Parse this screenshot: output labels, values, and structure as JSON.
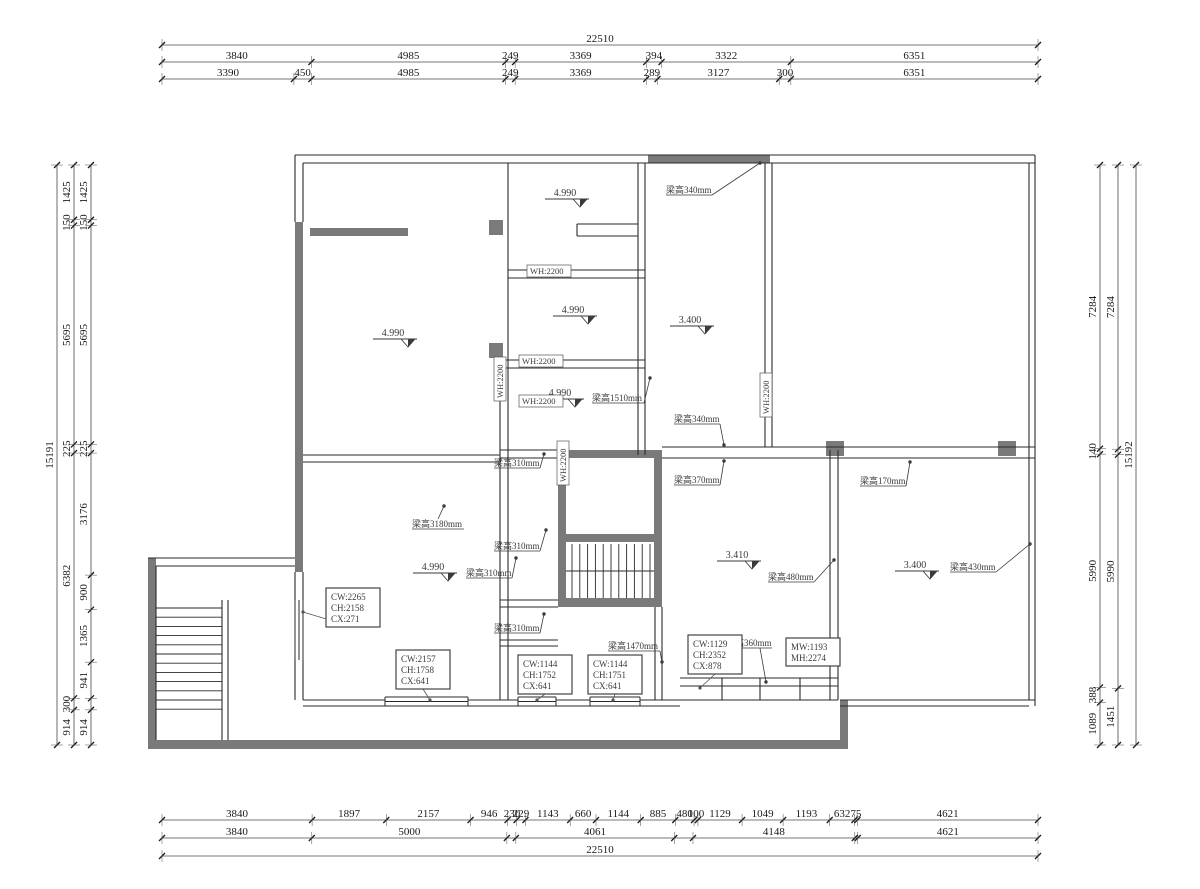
{
  "page": {
    "background": "#ffffff"
  },
  "colors": {
    "wall_fill": "#7a7a7a",
    "line": "#2a2a2a",
    "dim_line": "#4a4a4a",
    "dim_text": "#1a1a1a",
    "annotation_text": "#3a3a3a",
    "background": "#ffffff"
  },
  "dimensions": {
    "top": {
      "overall": "22510",
      "row2": [
        "3840",
        "4985",
        "249",
        "3369",
        "394",
        "3322",
        "6351"
      ],
      "row3": [
        "3390",
        "450",
        "4985",
        "249",
        "3369",
        "289",
        "3127",
        "300",
        "6351"
      ]
    },
    "bottom": {
      "row1": [
        "3840",
        "1897",
        "2157",
        "946",
        "230",
        "229",
        "1143",
        "660",
        "1144",
        "885",
        "480",
        "100",
        "1129",
        "1049",
        "1193",
        "632",
        "75",
        "4621"
      ],
      "row2": [
        "3840",
        "5000",
        "4061",
        "4148",
        "4621"
      ],
      "overall": "22510"
    },
    "left": {
      "overall": "15191",
      "chain_mid": [
        "1425",
        "150",
        "5695",
        "225",
        "6382",
        "300",
        "914"
      ],
      "chain_inner": [
        "1425",
        "150",
        "5695",
        "225",
        "3176",
        "900",
        "1365",
        "941",
        "914"
      ]
    },
    "right": {
      "overall": "15192",
      "chain_inner": [
        "7284",
        "140",
        "5990",
        "388",
        "1089"
      ],
      "chain_mid": [
        "7284",
        "5990",
        "1451"
      ]
    }
  },
  "level_markers": [
    "4.990",
    "4.990",
    "4.990",
    "4.990",
    "3.400",
    "3.410",
    "3.400",
    "4.990"
  ],
  "beam_labels": [
    "梁高340mm",
    "梁高1510mm",
    "梁高340mm",
    "梁高370mm",
    "梁高170mm",
    "梁高480mm",
    "梁高430mm",
    "梁高3180mm",
    "梁高310mm",
    "梁高310mm",
    "梁高310mm",
    "梁高310mm",
    "梁高1470mm",
    "梁高360mm"
  ],
  "window_height_labels": [
    "WH:2200",
    "WH:2200",
    "WH:2200",
    "WH:2200",
    "WH:2200",
    "WH:2200"
  ],
  "opening_size_boxes": [
    {
      "lines": [
        "CW:2265",
        "CH:2158",
        "CX:271"
      ]
    },
    {
      "lines": [
        "CW:2157",
        "CH:1758",
        "CX:641"
      ]
    },
    {
      "lines": [
        "CW:1144",
        "CH:1752",
        "CX:641"
      ]
    },
    {
      "lines": [
        "CW:1144",
        "CH:1751",
        "CX:641"
      ]
    },
    {
      "lines": [
        "CW:1129",
        "CH:2352",
        "CX:878"
      ]
    },
    {
      "lines": [
        "MW:1193",
        "MH:2274"
      ]
    }
  ]
}
